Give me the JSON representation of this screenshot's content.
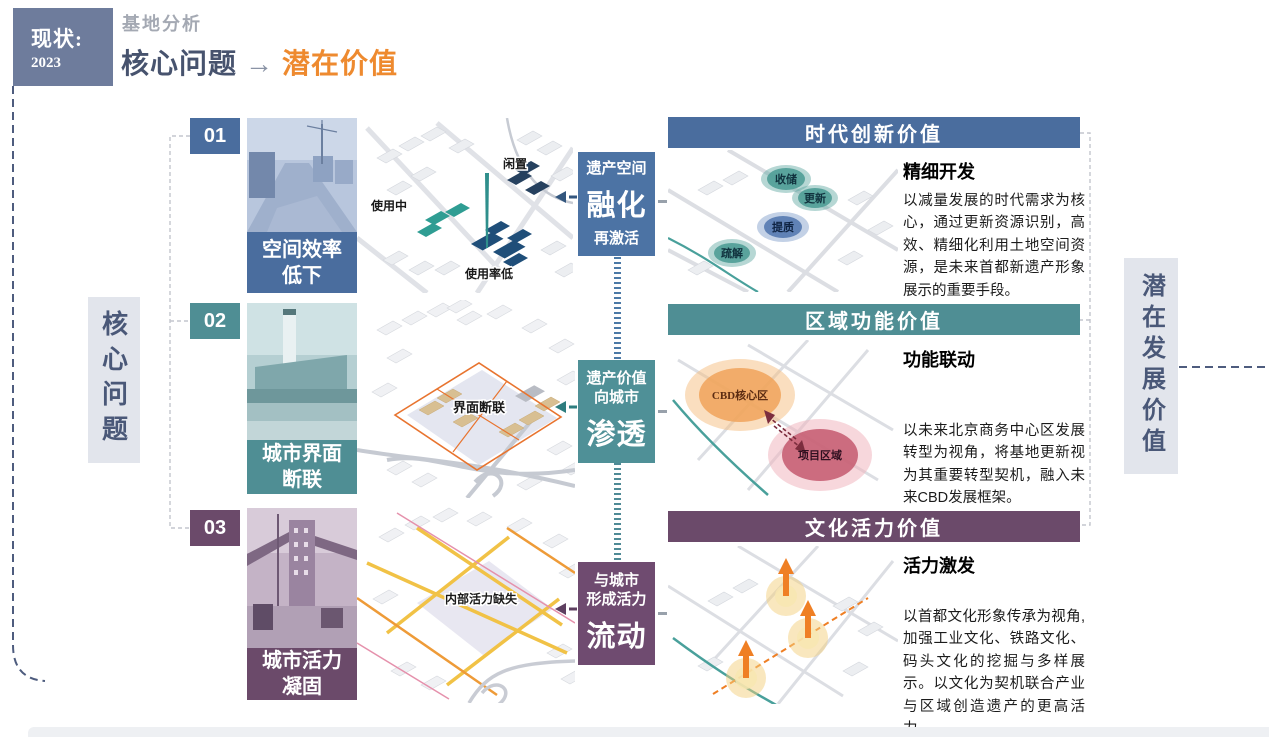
{
  "palette": {
    "row1_blue": "#4a6d9e",
    "row2_teal": "#4f8e94",
    "row3_purple": "#6b4a6a",
    "accent_orange": "#ee8a2f",
    "slate_text": "#4a5878",
    "tag_bg": "#6e7c9c"
  },
  "header": {
    "tag": {
      "line1": "现状:",
      "line2": "2023"
    },
    "kicker": "基地分析",
    "title": {
      "left": "核心问题",
      "arrow": "→",
      "right": "潜在价值"
    }
  },
  "axes": {
    "left": "核心问题",
    "right": "潜在发展价值"
  },
  "rows": [
    {
      "number": "01",
      "problem": "空间效率\n低下",
      "axon_labels": [
        "使用中",
        "闲置",
        "使用率低"
      ],
      "mid": {
        "top": "遗产空间",
        "big": "融化",
        "bottom": "再激活"
      },
      "panel": {
        "title": "时代创新价值",
        "subtitle": "精细开发",
        "body": "以减量发展的时代需求为核心，通过更新资源识别，高效、精细化利用土地空间资源，是未来首都新遗产形象展示的重要手段。",
        "bubbles": [
          "收储",
          "更新",
          "提质",
          "疏解"
        ]
      }
    },
    {
      "number": "02",
      "problem": "城市界面\n断联",
      "axon_labels": [
        "界面断联"
      ],
      "mid": {
        "top": "遗产价值\n向城市",
        "big": "渗透"
      },
      "panel": {
        "title": "区域功能价值",
        "subtitle": "功能联动",
        "body": "以未来北京商务中心区发展转型为视角，将基地更新视为其重要转型契机，融入未来CBD发展框架。",
        "map_labels": {
          "cbd": "CBD核心区",
          "project": "项目区域"
        }
      }
    },
    {
      "number": "03",
      "problem": "城市活力\n凝固",
      "axon_labels": [
        "内部活力缺失"
      ],
      "mid": {
        "top": "与城市\n形成活力",
        "big": "流动"
      },
      "panel": {
        "title": "文化活力价值",
        "subtitle": "活力激发",
        "body": "以首都文化形象传承为视角,加强工业文化、铁路文化、码头文化的挖掘与多样展示。以文化为契机联合产业与区域创造遗产的更高活力。"
      }
    }
  ]
}
